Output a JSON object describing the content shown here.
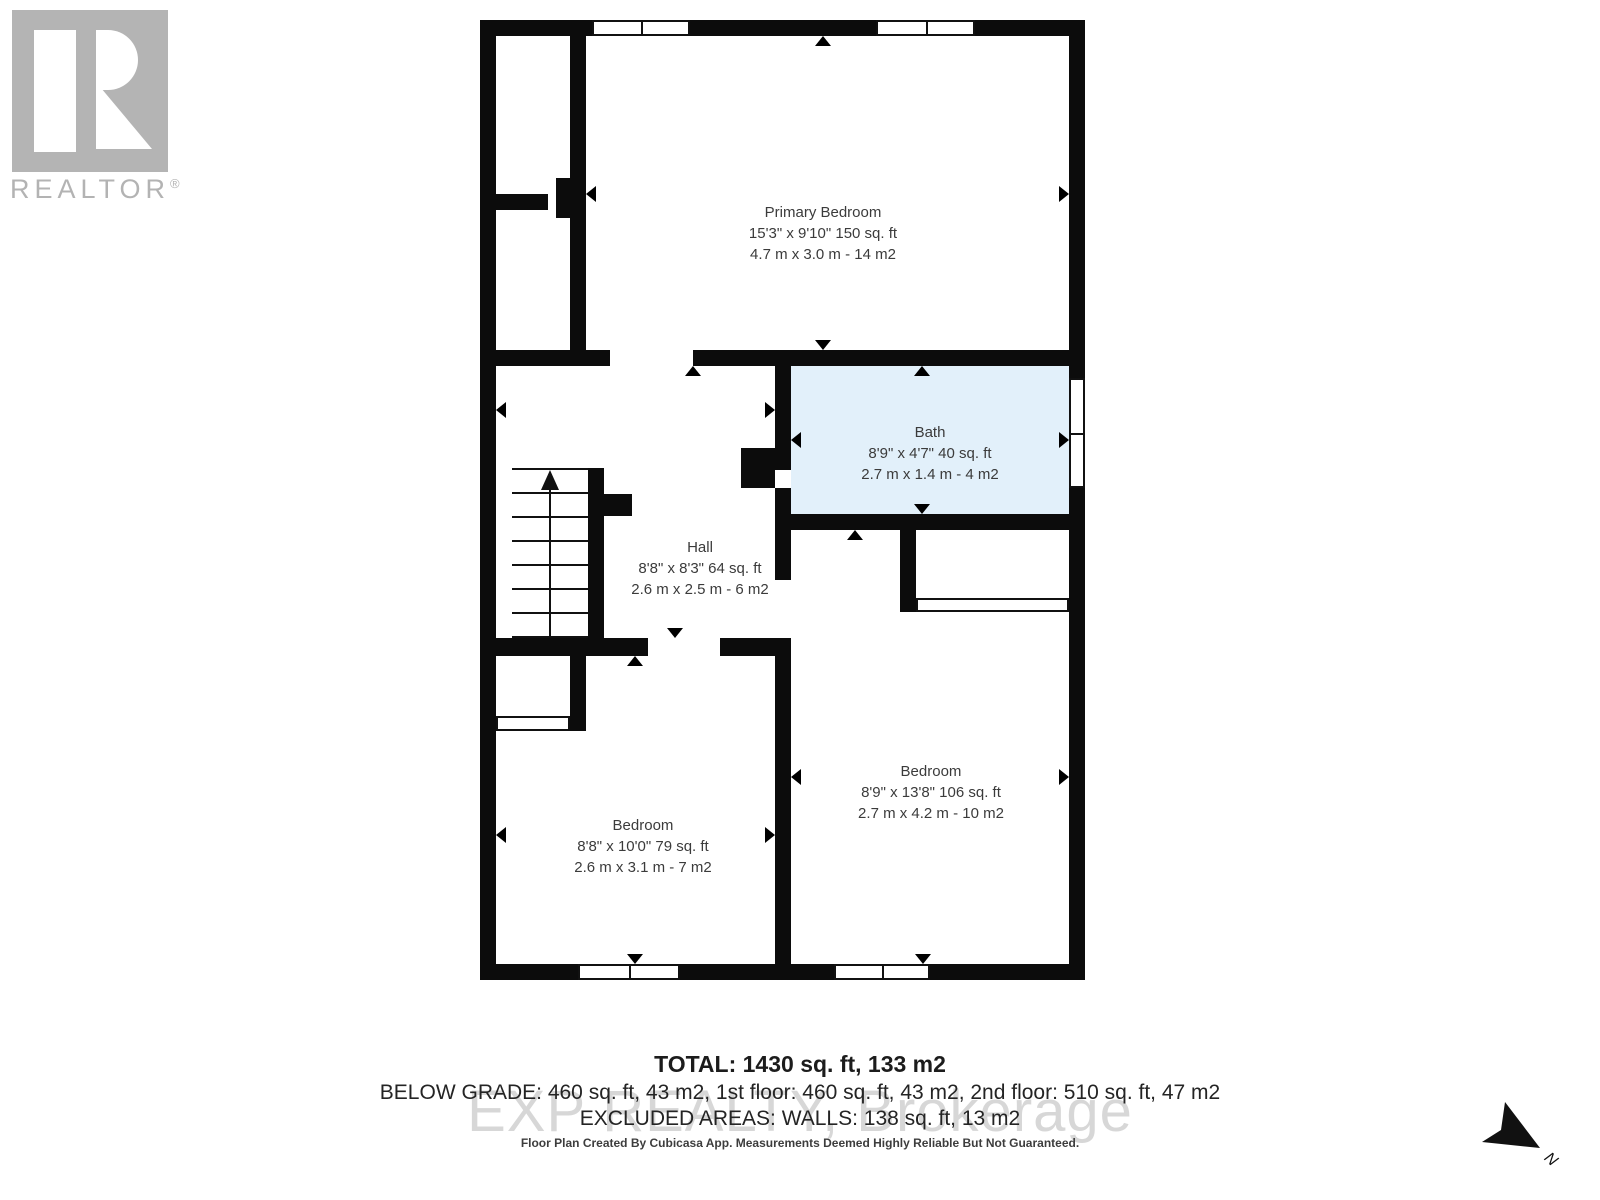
{
  "branding": {
    "logo_word": "REALTOR",
    "registered_mark": "®"
  },
  "watermark_text": "EXP REALTY, Brokerage",
  "rooms": [
    {
      "name": "Primary Bedroom",
      "imperial": "15'3\" x 9'10\" 150 sq. ft",
      "metric": "4.7 m x 3.0 m - 14 m2"
    },
    {
      "name": "Bath",
      "imperial": "8'9\" x 4'7\" 40 sq. ft",
      "metric": "2.7 m x 1.4 m - 4 m2"
    },
    {
      "name": "Hall",
      "imperial": "8'8\" x 8'3\" 64 sq. ft",
      "metric": "2.6 m x 2.5 m - 6 m2"
    },
    {
      "name": "Bedroom",
      "imperial": "8'8\" x 10'0\" 79 sq. ft",
      "metric": "2.6 m x 3.1 m - 7 m2"
    },
    {
      "name": "Bedroom",
      "imperial": "8'9\" x 13'8\" 106 sq. ft",
      "metric": "2.7 m x 4.2 m - 10 m2"
    }
  ],
  "summary": {
    "total": "TOTAL: 1430 sq. ft, 133 m2",
    "breakdown": "BELOW GRADE: 460 sq. ft, 43 m2, 1st floor: 460 sq. ft, 43 m2, 2nd floor: 510 sq. ft, 47 m2",
    "excluded": "EXCLUDED AREAS: WALLS: 138 sq. ft, 13 m2"
  },
  "footer_note": "Floor Plan Created By Cubicasa App. Measurements Deemed Highly Reliable But Not Guaranteed.",
  "compass": {
    "label": "N"
  },
  "colors": {
    "wall": "#0c0c0c",
    "bath_fill": "#e2f0fa",
    "watermark": "#d7d7d7",
    "logo_gray": "#b4b4b4",
    "label_text": "#3b3b3b"
  }
}
